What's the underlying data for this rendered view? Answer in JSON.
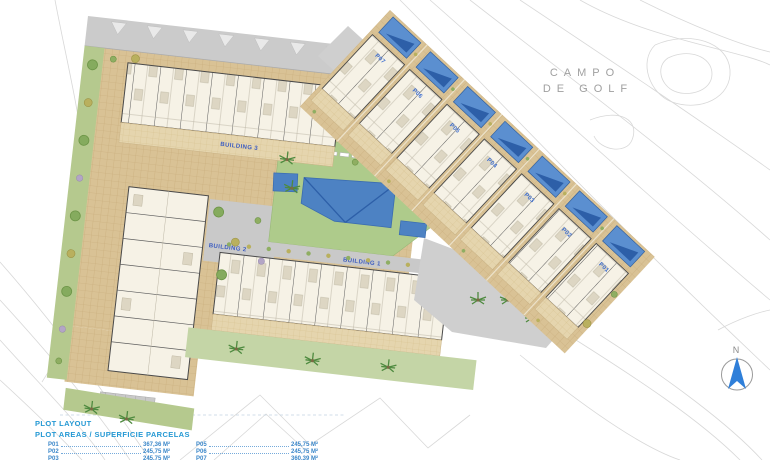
{
  "legend": {
    "title": "PLOT LAYOUT",
    "subtitle": "PLOT AREAS / SUPERFICIE PARCELAS",
    "col1": [
      {
        "label": "P01",
        "value": "367,36 M²"
      },
      {
        "label": "P02",
        "value": "245,75 M²"
      },
      {
        "label": "P03",
        "value": "245,75 M²"
      }
    ],
    "col2": [
      {
        "label": "P05",
        "value": "245,75 M²"
      },
      {
        "label": "P06",
        "value": "245,75 M²"
      },
      {
        "label": "P07",
        "value": "360,39 M²"
      }
    ]
  },
  "map": {
    "golf_line1": "CAMPO",
    "golf_line2": "DE GOLF",
    "building1": "BUILDING 1",
    "building2": "BUILDING 2",
    "building3": "BUILDING 3",
    "plots": [
      "P07",
      "P06",
      "P05",
      "P04",
      "P03",
      "P02",
      "P01"
    ],
    "compass": "N"
  },
  "colors": {
    "pool_blue": "#4d82c3",
    "pool_dark_blue": "#2d5fa8",
    "paving_tan": "#d9c295",
    "terrace_tan": "#e5d5ae",
    "lawn_green": "#aecb8b",
    "band_green": "#c4d5a6",
    "road_gray": "#cbcbcb",
    "contour_gray": "#d8d8d8",
    "legend_blue": "#2599d4",
    "building_label_blue": "#3c5cc0",
    "plot_label_blue": "#3f6fd0",
    "golf_text_gray": "#a0a0a0"
  }
}
